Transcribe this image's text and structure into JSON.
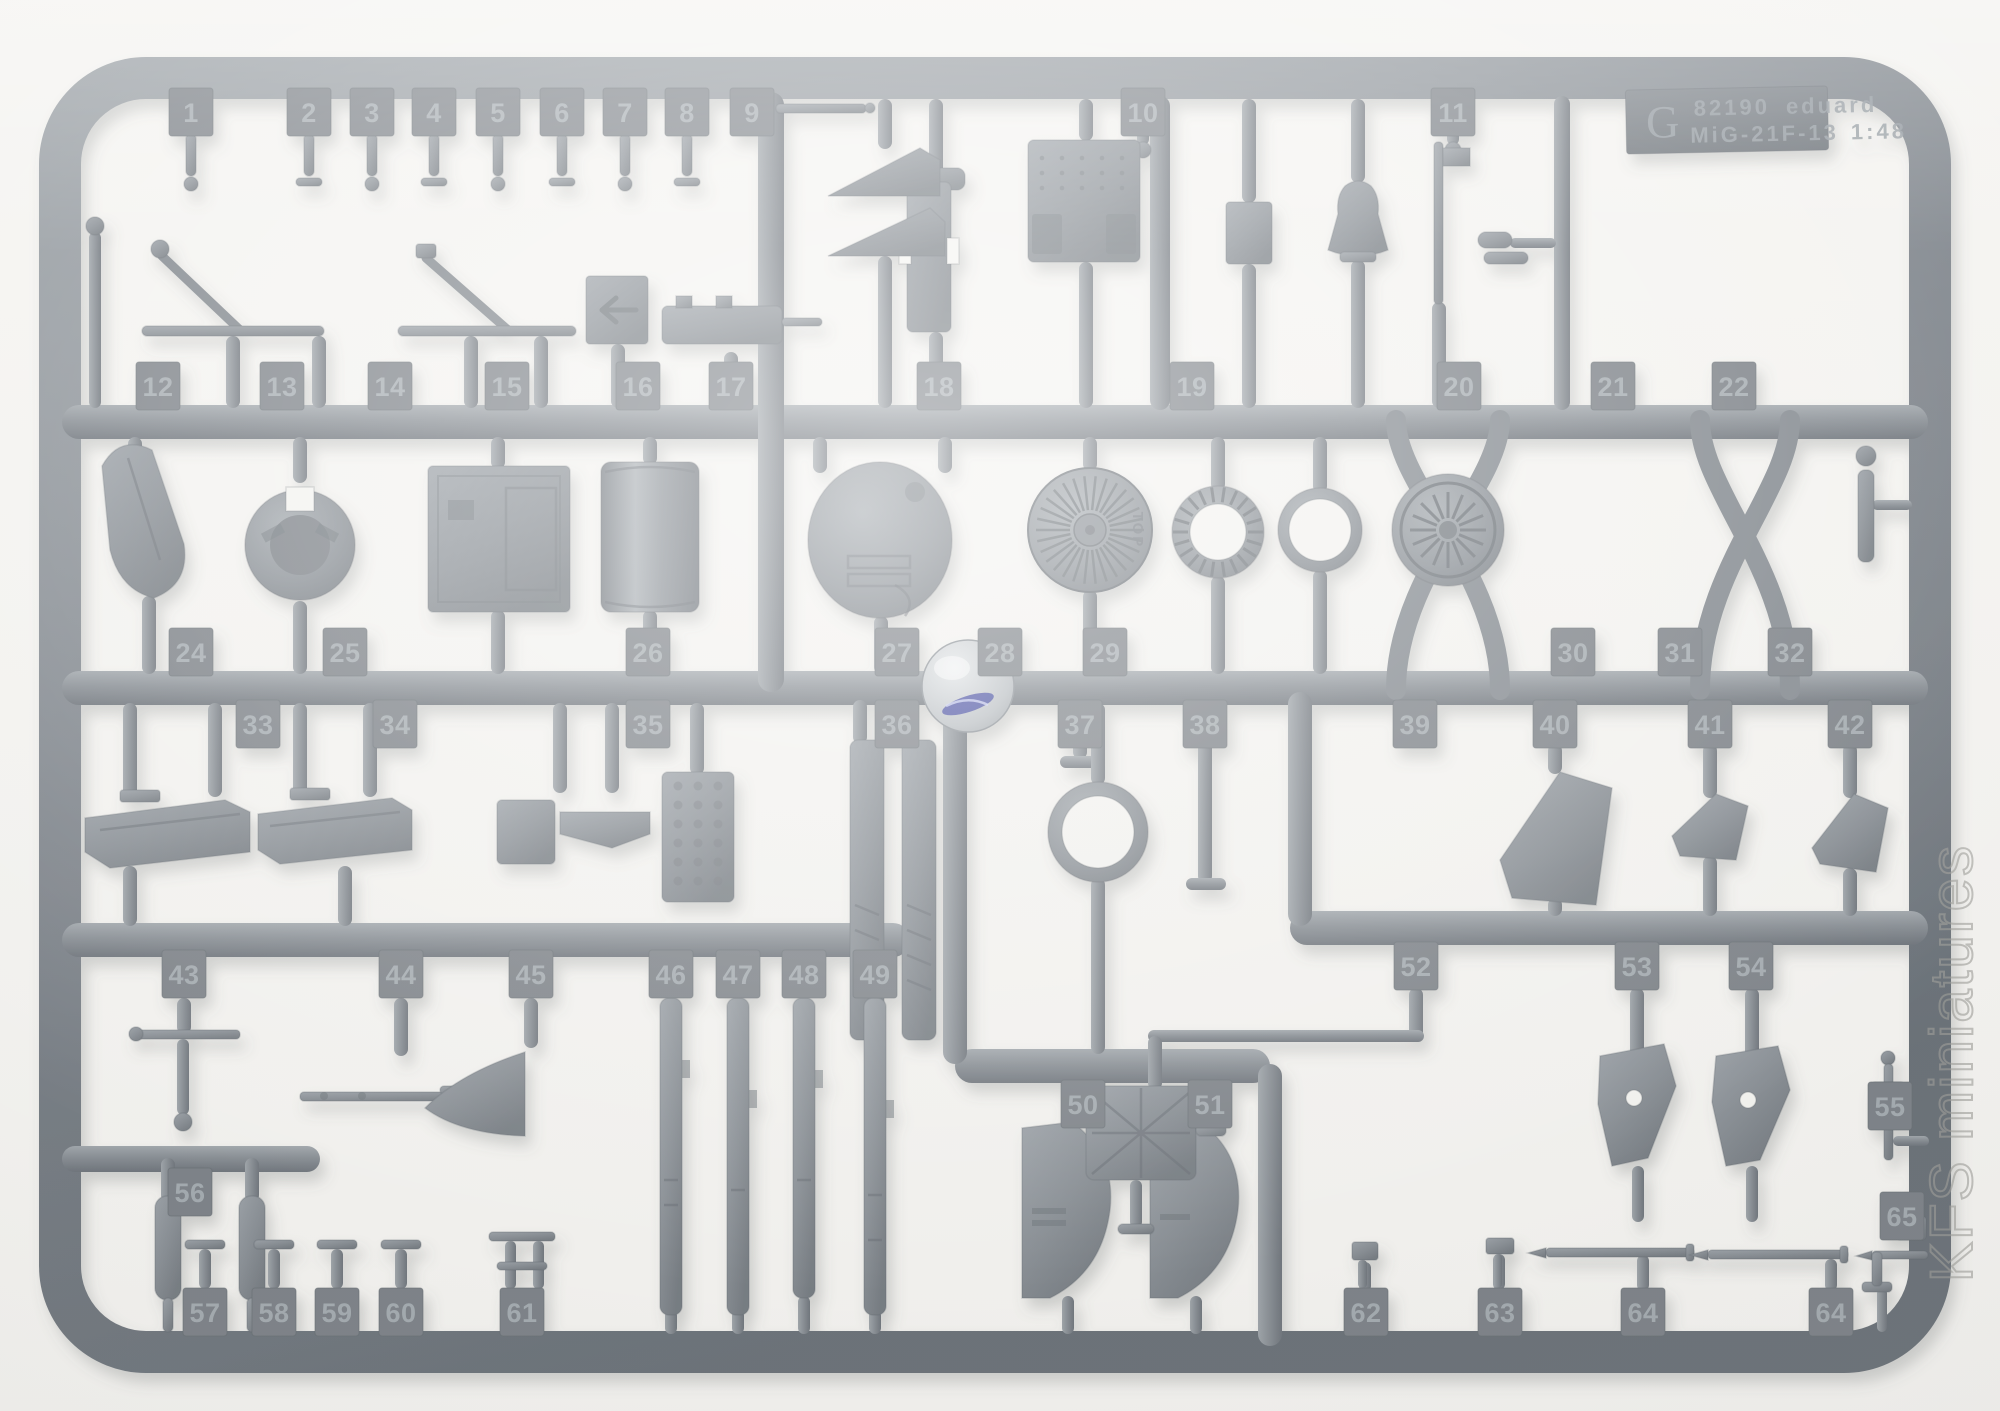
{
  "label_plate": {
    "sprue_letter": "G",
    "product_code": "82190",
    "brand": "eduard",
    "model": "MiG-21F-13",
    "scale": "1:48"
  },
  "markings": {
    "top_marking": "TOP"
  },
  "watermark": {
    "text": "KFS miniatures"
  },
  "colors": {
    "background": "#f4f3f0",
    "plastic": "#8a9096",
    "plastic_dark": "#6b7278",
    "plastic_light": "#b6bcc1",
    "tab_text": "#a6adb2",
    "plate_text": "#99a0a6",
    "swirl_blue": "#3a3f9c",
    "watermark_gray": "#9e9e9a"
  },
  "part_tabs": [
    {
      "n": "1",
      "x": 191,
      "y": 88
    },
    {
      "n": "2",
      "x": 309,
      "y": 88
    },
    {
      "n": "3",
      "x": 372,
      "y": 88
    },
    {
      "n": "4",
      "x": 434,
      "y": 88
    },
    {
      "n": "5",
      "x": 498,
      "y": 88
    },
    {
      "n": "6",
      "x": 562,
      "y": 88
    },
    {
      "n": "7",
      "x": 625,
      "y": 88
    },
    {
      "n": "8",
      "x": 687,
      "y": 88
    },
    {
      "n": "9",
      "x": 752,
      "y": 88
    },
    {
      "n": "10",
      "x": 1143,
      "y": 88
    },
    {
      "n": "11",
      "x": 1453,
      "y": 88
    },
    {
      "n": "12",
      "x": 158,
      "y": 362
    },
    {
      "n": "13",
      "x": 282,
      "y": 362
    },
    {
      "n": "14",
      "x": 390,
      "y": 362
    },
    {
      "n": "15",
      "x": 507,
      "y": 362
    },
    {
      "n": "16",
      "x": 638,
      "y": 362
    },
    {
      "n": "17",
      "x": 731,
      "y": 362
    },
    {
      "n": "18",
      "x": 939,
      "y": 362
    },
    {
      "n": "19",
      "x": 1192,
      "y": 362
    },
    {
      "n": "20",
      "x": 1459,
      "y": 362
    },
    {
      "n": "21",
      "x": 1613,
      "y": 362
    },
    {
      "n": "22",
      "x": 1734,
      "y": 362
    },
    {
      "n": "24",
      "x": 191,
      "y": 628
    },
    {
      "n": "25",
      "x": 345,
      "y": 628
    },
    {
      "n": "26",
      "x": 648,
      "y": 628
    },
    {
      "n": "27",
      "x": 897,
      "y": 628
    },
    {
      "n": "28",
      "x": 1000,
      "y": 628
    },
    {
      "n": "29",
      "x": 1105,
      "y": 628
    },
    {
      "n": "30",
      "x": 1573,
      "y": 628
    },
    {
      "n": "31",
      "x": 1680,
      "y": 628
    },
    {
      "n": "32",
      "x": 1790,
      "y": 628
    },
    {
      "n": "33",
      "x": 258,
      "y": 700
    },
    {
      "n": "34",
      "x": 395,
      "y": 700
    },
    {
      "n": "35",
      "x": 648,
      "y": 700
    },
    {
      "n": "36",
      "x": 897,
      "y": 700
    },
    {
      "n": "37",
      "x": 1080,
      "y": 700
    },
    {
      "n": "38",
      "x": 1205,
      "y": 700
    },
    {
      "n": "39",
      "x": 1415,
      "y": 700
    },
    {
      "n": "40",
      "x": 1555,
      "y": 700
    },
    {
      "n": "41",
      "x": 1710,
      "y": 700
    },
    {
      "n": "42",
      "x": 1850,
      "y": 700
    },
    {
      "n": "43",
      "x": 184,
      "y": 950
    },
    {
      "n": "44",
      "x": 401,
      "y": 950
    },
    {
      "n": "45",
      "x": 531,
      "y": 950
    },
    {
      "n": "46",
      "x": 671,
      "y": 950
    },
    {
      "n": "47",
      "x": 738,
      "y": 950
    },
    {
      "n": "48",
      "x": 804,
      "y": 950
    },
    {
      "n": "49",
      "x": 875,
      "y": 950
    },
    {
      "n": "50",
      "x": 1083,
      "y": 1080
    },
    {
      "n": "51",
      "x": 1210,
      "y": 1080
    },
    {
      "n": "52",
      "x": 1416,
      "y": 942
    },
    {
      "n": "53",
      "x": 1637,
      "y": 942
    },
    {
      "n": "54",
      "x": 1751,
      "y": 942
    },
    {
      "n": "55",
      "x": 1890,
      "y": 1082
    },
    {
      "n": "56",
      "x": 190,
      "y": 1168
    },
    {
      "n": "57",
      "x": 205,
      "y": 1288
    },
    {
      "n": "58",
      "x": 274,
      "y": 1288
    },
    {
      "n": "59",
      "x": 337,
      "y": 1288
    },
    {
      "n": "60",
      "x": 401,
      "y": 1288
    },
    {
      "n": "61",
      "x": 522,
      "y": 1288
    },
    {
      "n": "62",
      "x": 1366,
      "y": 1288
    },
    {
      "n": "63",
      "x": 1500,
      "y": 1288
    },
    {
      "n": "64",
      "x": 1643,
      "y": 1288
    },
    {
      "n": "64",
      "x": 1831,
      "y": 1288
    },
    {
      "n": "65",
      "x": 1902,
      "y": 1192
    }
  ]
}
